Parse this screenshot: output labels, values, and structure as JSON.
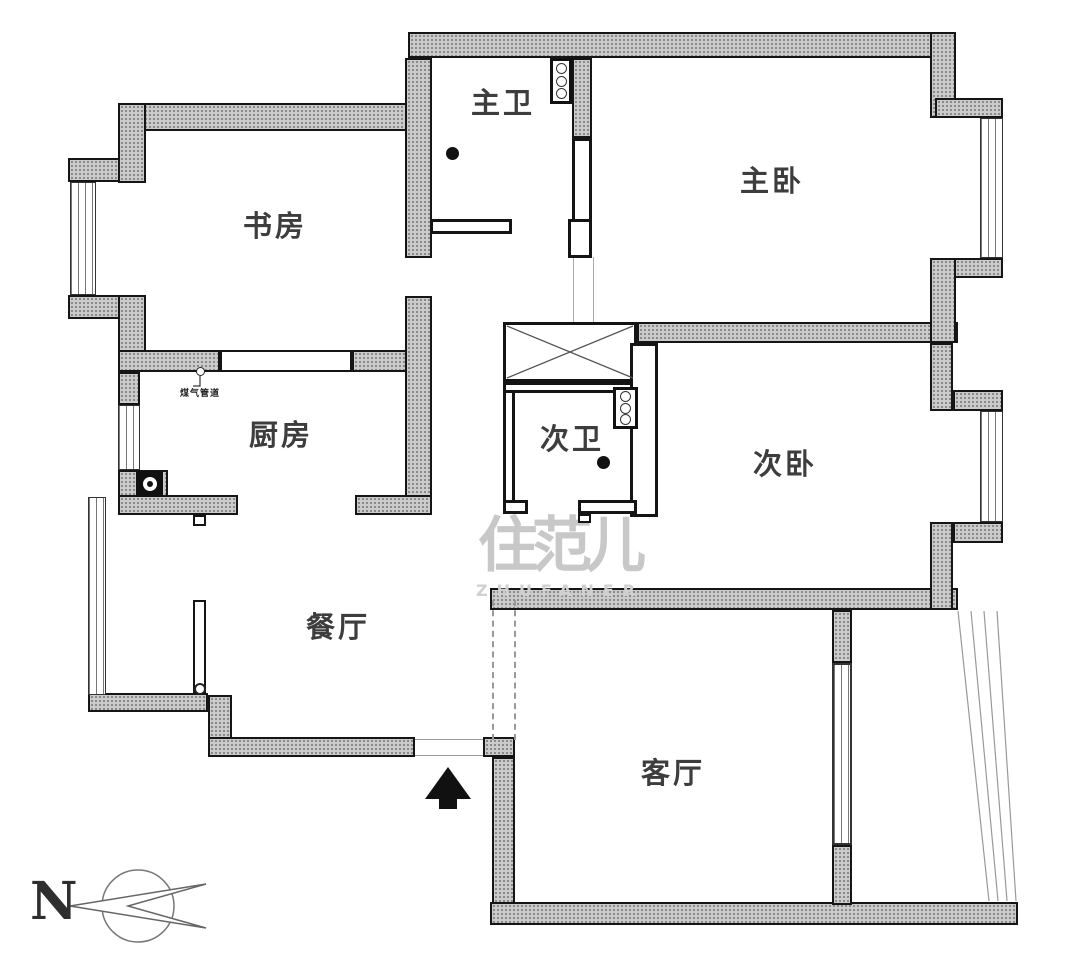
{
  "rooms": {
    "study": "书房",
    "master_bath": "主卫",
    "master_bedroom": "主卧",
    "kitchen": "厨房",
    "second_bath": "次卫",
    "second_bedroom": "次卧",
    "dining": "餐厅",
    "living": "客厅"
  },
  "annotations": {
    "gas_pipe": "煤气管道",
    "north_letter": "N"
  },
  "watermark": {
    "text": "住范儿",
    "letters": "ZHUFANER"
  },
  "colors": {
    "wall_fill": "#cbcbcb",
    "wall_dot": "#828282",
    "outline": "#151515",
    "label_text": "#3d3d3d",
    "watermark_gray": "#c8c8c8"
  }
}
